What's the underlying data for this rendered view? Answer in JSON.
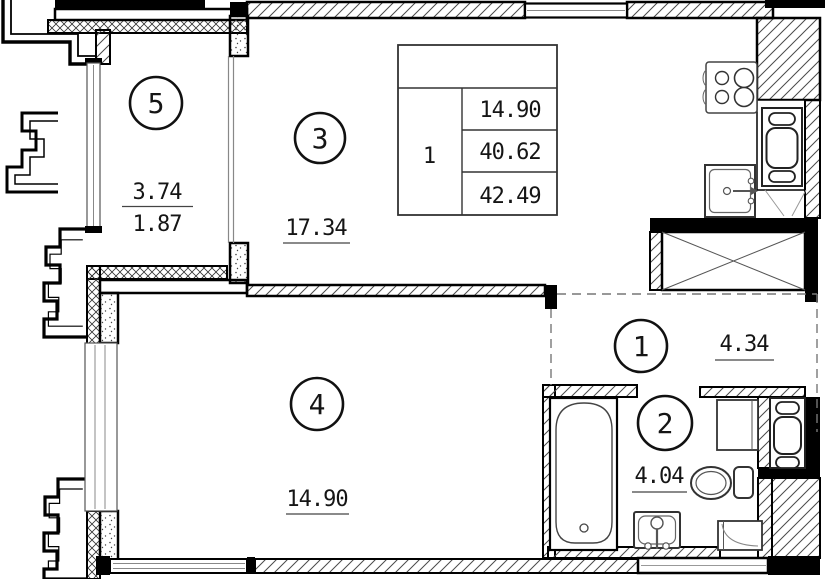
{
  "rooms": {
    "r1": {
      "number": "1",
      "area": "4.34"
    },
    "r2": {
      "number": "2",
      "area": "4.04"
    },
    "r3": {
      "number": "3",
      "area": "17.34"
    },
    "r4": {
      "number": "4",
      "area": "14.90"
    },
    "r5": {
      "number": "5",
      "area_numerator": "3.74",
      "area_denominator": "1.87"
    }
  },
  "area_table": {
    "unit_number": "1",
    "values": [
      "14.90",
      "40.62",
      "42.49"
    ]
  },
  "fixtures": [
    "stove-icon",
    "kitchen-sink-icon",
    "refrigerator-icon",
    "vent-shaft-icon",
    "bathtub-icon",
    "bath-sink-icon",
    "toilet-icon",
    "washing-machine-icon",
    "water-heater-icon",
    "corner-cabinet-icon"
  ],
  "colors": {
    "wall": "#000000",
    "hatch": "#4a4a4a",
    "crosshatch": "#333333",
    "background": "#ffffff",
    "dashed_zone": "#777777",
    "text": "#151515"
  }
}
